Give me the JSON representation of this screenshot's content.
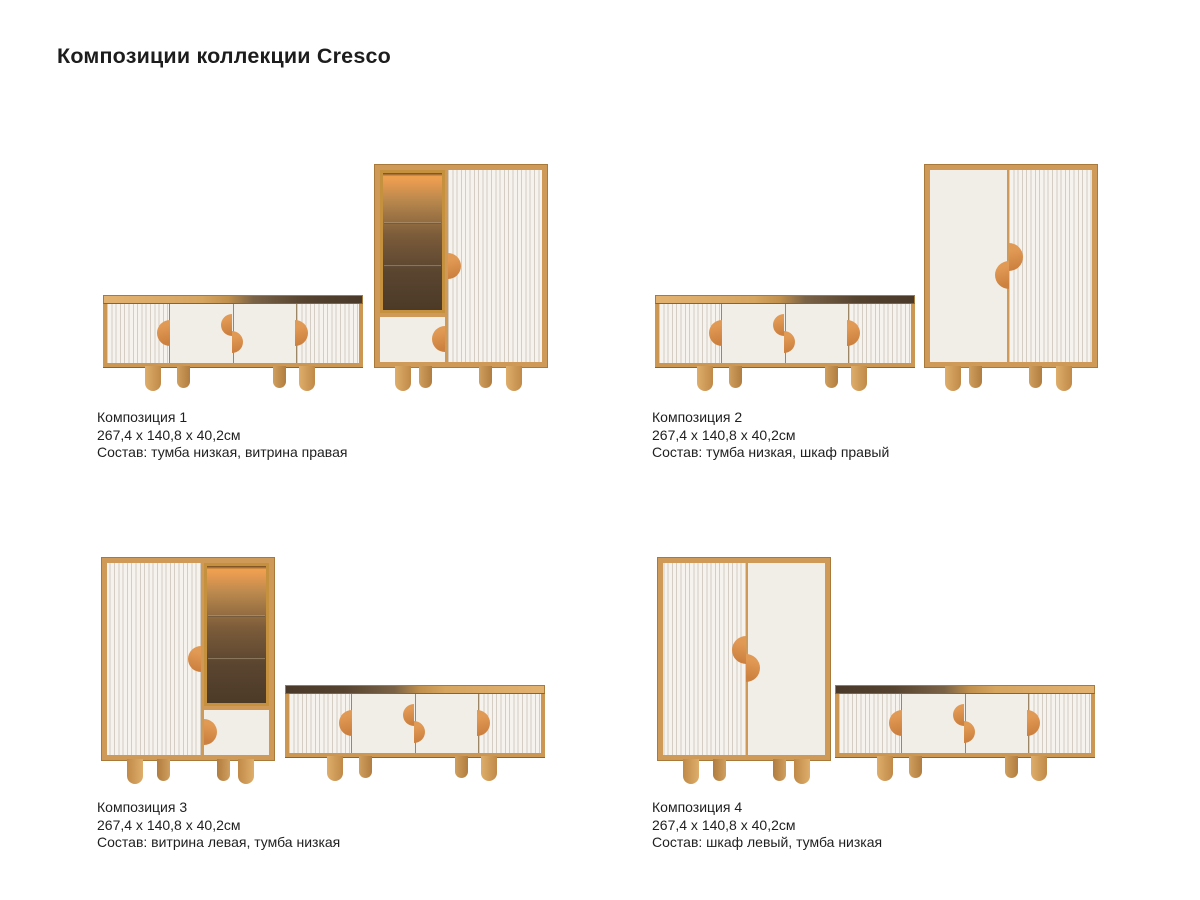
{
  "page": {
    "title": "Композиции коллекции Cresco",
    "background": "#ffffff"
  },
  "colors": {
    "text": "#1f1f1f",
    "wood_frame": "#cf9a57",
    "wood_light": "#e3b271",
    "wood_dark": "#4a392a",
    "panel_white": "#f1eee8",
    "flute_line": "#d3cdc3",
    "handle_orange": "#d9924d",
    "display_glow": "#f0a24f",
    "display_interior": "#4c3a27"
  },
  "compositions": [
    {
      "name": "Композиция 1",
      "dimensions": "267,4 x 140,8 x 40,2см",
      "contents": "Состав: тумба низкая, витрина правая"
    },
    {
      "name": "Композиция 2",
      "dimensions": "267,4 x 140,8 x 40,2см",
      "contents": "Состав: тумба низкая, шкаф правый"
    },
    {
      "name": "Композиция 3",
      "dimensions": "267,4 x 140,8 x 40,2см",
      "contents": "Состав: витрина левая, тумба низкая"
    },
    {
      "name": "Композиция 4",
      "dimensions": "267,4 x 140,8 x 40,2см",
      "contents": "Состав: шкаф левый, тумба низкая"
    }
  ]
}
